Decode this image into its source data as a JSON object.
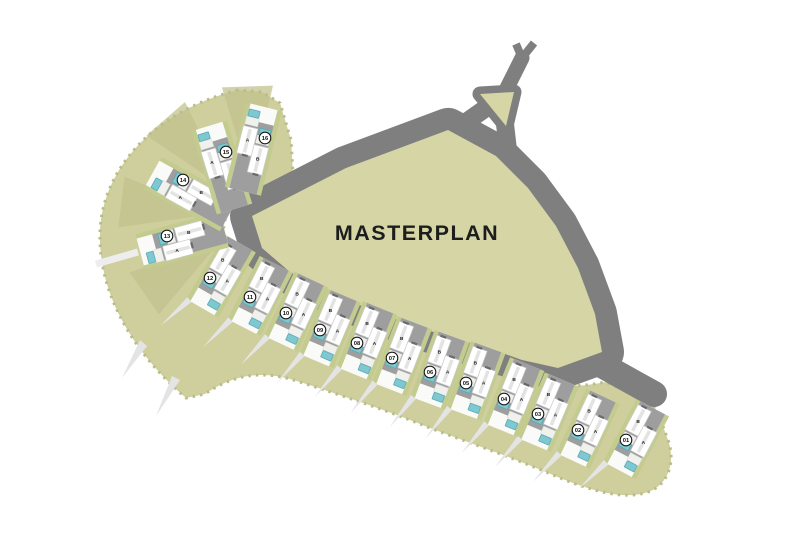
{
  "title": "MASTERPLAN",
  "map": {
    "colors": {
      "background": "#ffffff",
      "road": "#7f7f7f",
      "central_green": "#d5d5a6",
      "band_green": "#cfcf9e",
      "band_edge": "#b9bd8a",
      "fan_wedge": "#c1c18d",
      "hedge": "#c3cb8f",
      "driveway": "#9e9e9e",
      "house": "#ffffff",
      "house_stroke": "#cccccc",
      "house_ridge": "#e3e3e3",
      "garage": "#6a6a6a",
      "terrace": "#f0f0ec",
      "pool": "#7ec9d1",
      "pool_stroke": "#58aab4",
      "tree_spike": "#e4e4e4",
      "badge_fill": "#ffffff",
      "badge_stroke": "#1a1a1a",
      "badge_text": "#111111",
      "unit_label": "#222222",
      "title_color": "#1d1d1d",
      "side_path": "#ededed"
    },
    "unit_labels": [
      "A",
      "B"
    ],
    "plots": [
      {
        "num": "01",
        "x": 626,
        "y": 440,
        "angle": 28,
        "ext": 0,
        "spike": true
      },
      {
        "num": "02",
        "x": 578,
        "y": 430,
        "angle": 25,
        "ext": 0,
        "spike": true
      },
      {
        "num": "03",
        "x": 538,
        "y": 414,
        "angle": 23,
        "ext": 0,
        "spike": true
      },
      {
        "num": "04",
        "x": 504,
        "y": 399,
        "angle": 22,
        "ext": 0,
        "spike": true
      },
      {
        "num": "05",
        "x": 466,
        "y": 383,
        "angle": 20,
        "ext": 0,
        "spike": true
      },
      {
        "num": "06",
        "x": 430,
        "y": 372,
        "angle": 20,
        "ext": 0,
        "spike": true
      },
      {
        "num": "07",
        "x": 392,
        "y": 358,
        "angle": 21,
        "ext": 0,
        "spike": true
      },
      {
        "num": "08",
        "x": 357,
        "y": 343,
        "angle": 22,
        "ext": 0,
        "spike": true
      },
      {
        "num": "09",
        "x": 320,
        "y": 330,
        "angle": 23,
        "ext": 0,
        "spike": true
      },
      {
        "num": "10",
        "x": 286,
        "y": 313,
        "angle": 25,
        "ext": 0,
        "spike": true
      },
      {
        "num": "11",
        "x": 250,
        "y": 297,
        "angle": 27,
        "ext": 0,
        "spike": true
      },
      {
        "num": "12",
        "x": 210,
        "y": 278,
        "angle": 30,
        "ext": 4,
        "spike": true
      },
      {
        "num": "13",
        "x": 167,
        "y": 236,
        "angle": 75,
        "ext": 16,
        "spike": false
      },
      {
        "num": "14",
        "x": 183,
        "y": 180,
        "angle": 119,
        "ext": 16,
        "spike": false
      },
      {
        "num": "15",
        "x": 226,
        "y": 152,
        "angle": 163,
        "ext": 16,
        "spike": false
      },
      {
        "num": "16",
        "x": 265,
        "y": 138,
        "angle": 194,
        "ext": 16,
        "spike": false
      }
    ],
    "fan_wedge_angles": [
      145,
      187,
      229,
      268
    ]
  }
}
